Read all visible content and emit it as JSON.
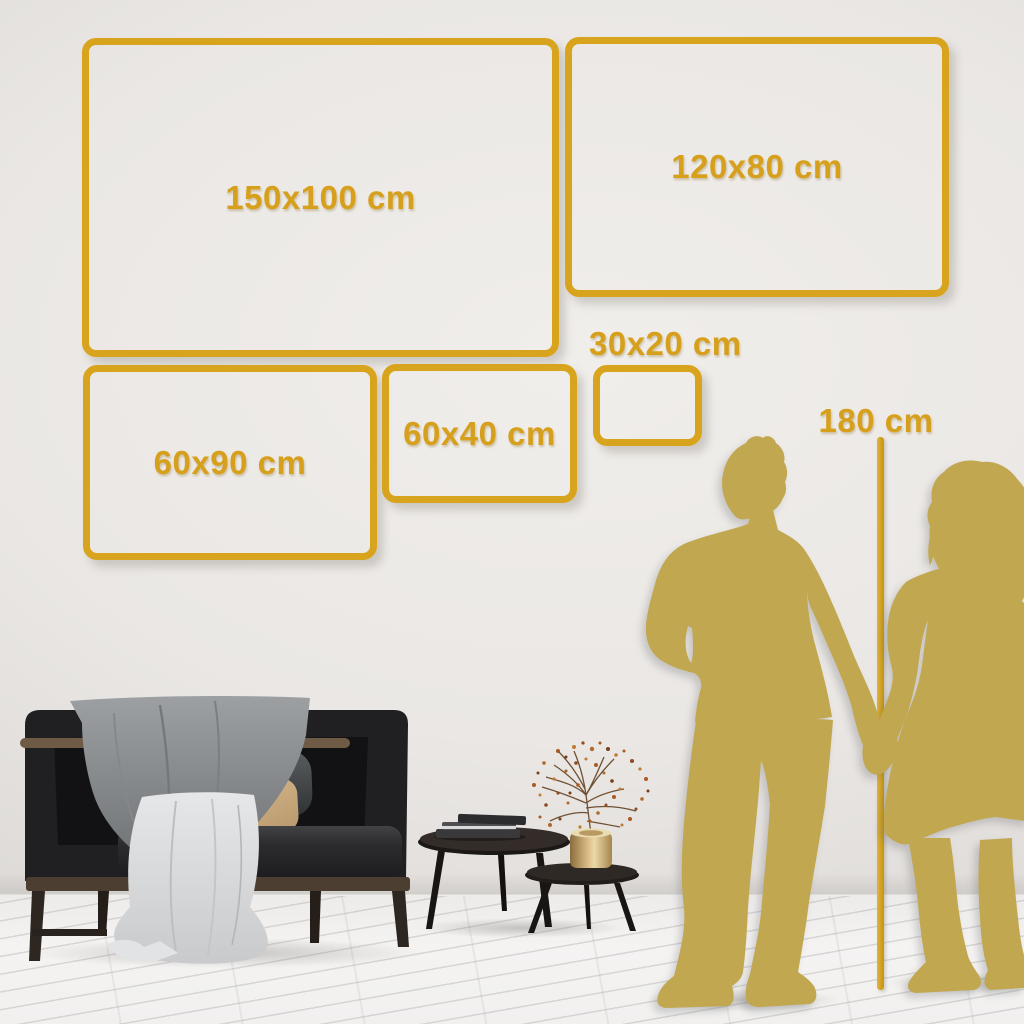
{
  "frames": [
    {
      "id": "frame-150x100",
      "label": "150x100 cm"
    },
    {
      "id": "frame-120x80",
      "label": "120x80 cm"
    },
    {
      "id": "frame-60x90",
      "label": "60x90 cm"
    },
    {
      "id": "frame-60x40",
      "label": "60x40 cm"
    },
    {
      "id": "frame-30x20",
      "label": "30x20 cm"
    }
  ],
  "height_marker": {
    "label": "180 cm"
  },
  "colors": {
    "frame_gold": "#D8A41E",
    "label_gold": "#D7A01C",
    "marker_line_gold": "#CB9B16",
    "silhouette_gold": "#C1A74F",
    "wall_light": "#EFEDEA",
    "wall_edge": "#D2CFCC",
    "floor_white": "#F2F1F0",
    "sofa_charcoal": "#1E1E20",
    "pillow_beige": "#D9BC92",
    "blanket_gray": "#8F9294",
    "throw_white": "#DEDFE0",
    "wood_dark": "#4C3E31",
    "vase_gold": "#D9BC85",
    "berry_rust": "#B06A2D"
  },
  "scene_objects": [
    "sofa",
    "throw-blanket",
    "white-throw",
    "pillows",
    "coffee-tables",
    "book-stack",
    "gold-vase",
    "dried-branch",
    "couple-silhouette",
    "height-line",
    "wood-floor"
  ]
}
